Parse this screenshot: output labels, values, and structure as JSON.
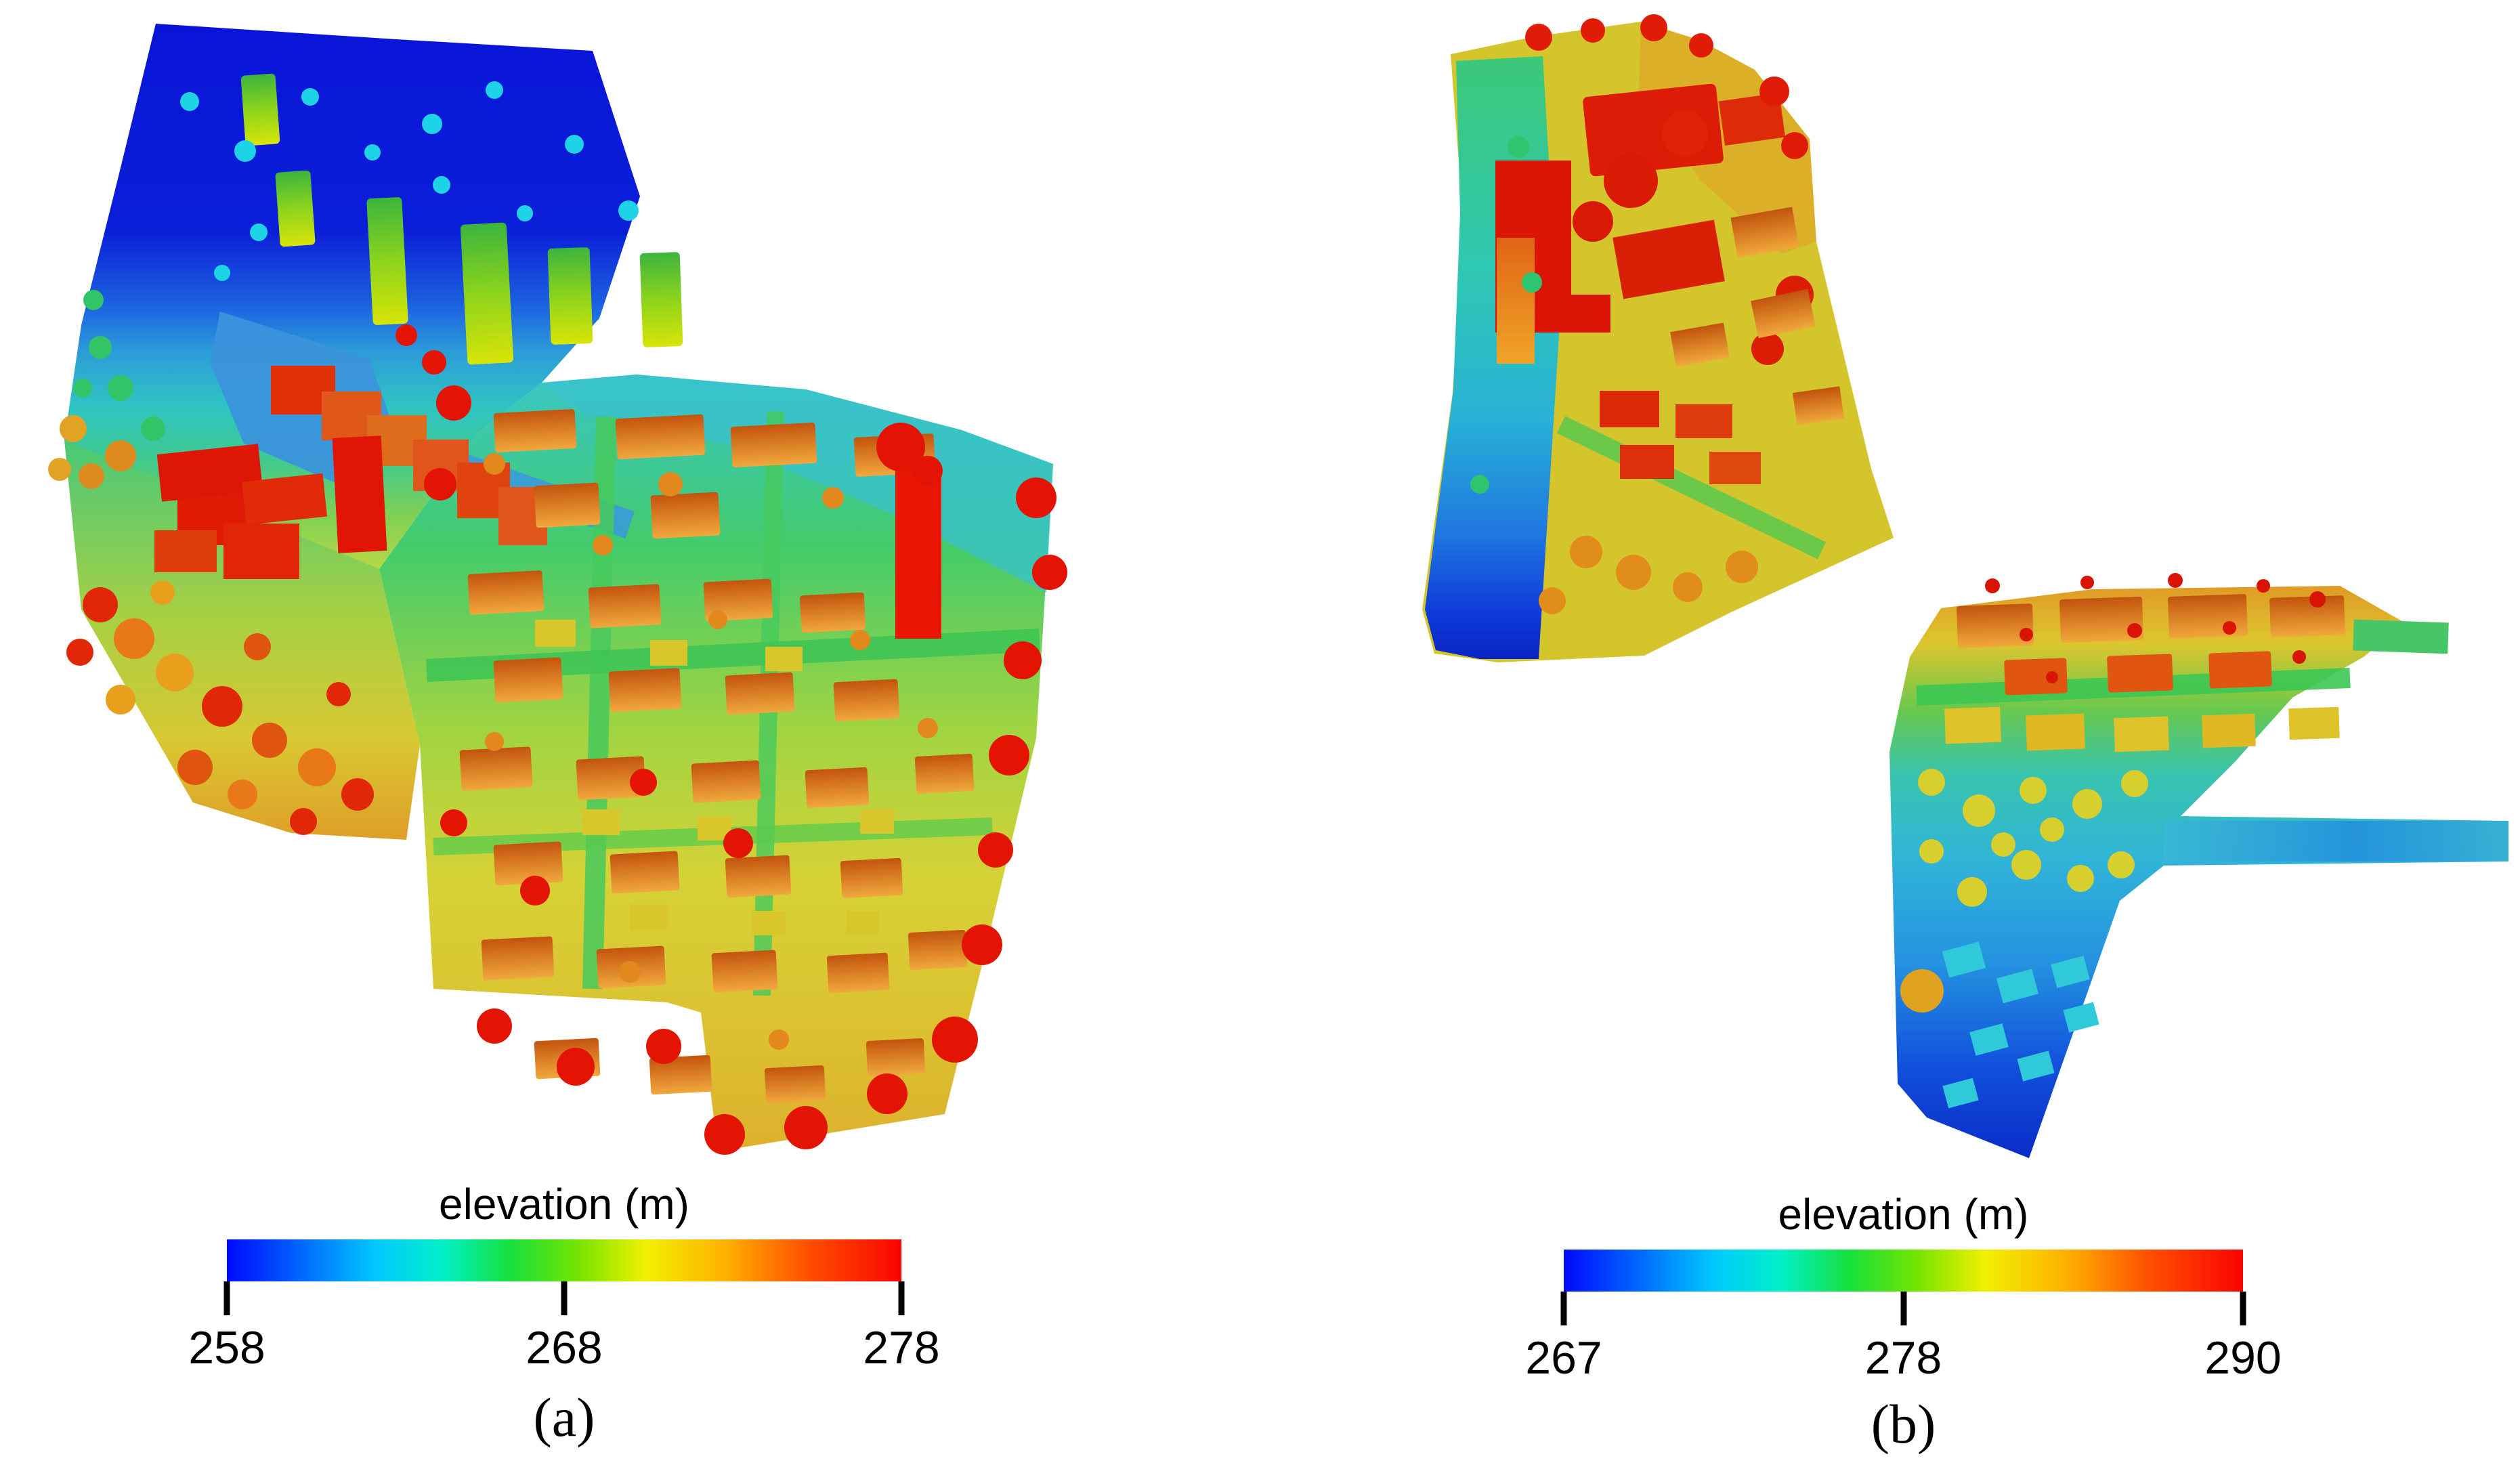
{
  "figure": {
    "background": "#ffffff",
    "text_color": "#000000",
    "panels": [
      {
        "id": "a",
        "caption": "(a)",
        "map_alt": "LiDAR elevation raster of urban area (a): low blue terrain (~258 m) in the north-west block with tall green-roofed buildings, rising through cyan and green streets to yellow-orange terrain (~270-278 m) in the south-east covered with red-roofed building rows and red tree crowns",
        "colorbar": {
          "title": "elevation (m)",
          "unit": "m",
          "min": 258,
          "max": 278,
          "ticks": [
            258,
            268,
            278
          ],
          "tick_positions": [
            0,
            0.5,
            1
          ],
          "gradient": [
            {
              "pos": 0,
              "color": "#0009ff"
            },
            {
              "pos": 0.12,
              "color": "#0070ff"
            },
            {
              "pos": 0.22,
              "color": "#00c8ff"
            },
            {
              "pos": 0.32,
              "color": "#00f0c8"
            },
            {
              "pos": 0.42,
              "color": "#16e03c"
            },
            {
              "pos": 0.52,
              "color": "#74e400"
            },
            {
              "pos": 0.62,
              "color": "#f0f000"
            },
            {
              "pos": 0.74,
              "color": "#ffb000"
            },
            {
              "pos": 0.86,
              "color": "#ff5000"
            },
            {
              "pos": 1,
              "color": "#fa0400"
            }
          ]
        }
      },
      {
        "id": "b",
        "caption": "(b)",
        "map_alt": "LiDAR elevation raster (b) in two disjoint patches: upper patch with a cyan-to-blue valley strip on its west edge and high red rooftops (~290 m) on yellow terrain to the east; lower patch sloping from orange-red building rows in the north through green and cyan to blue terrain (~267 m) at the south tip, with a thin cyan corridor extending east",
        "colorbar": {
          "title": "elevation (m)",
          "unit": "m",
          "min": 267,
          "max": 290,
          "ticks": [
            267,
            278,
            290
          ],
          "tick_positions": [
            0,
            0.5,
            1
          ],
          "gradient": [
            {
              "pos": 0,
              "color": "#0009ff"
            },
            {
              "pos": 0.12,
              "color": "#0070ff"
            },
            {
              "pos": 0.22,
              "color": "#00c8ff"
            },
            {
              "pos": 0.32,
              "color": "#00f0c8"
            },
            {
              "pos": 0.42,
              "color": "#16e03c"
            },
            {
              "pos": 0.52,
              "color": "#74e400"
            },
            {
              "pos": 0.62,
              "color": "#f0f000"
            },
            {
              "pos": 0.74,
              "color": "#ffb000"
            },
            {
              "pos": 0.86,
              "color": "#ff5000"
            },
            {
              "pos": 1,
              "color": "#fa0400"
            }
          ]
        }
      }
    ]
  },
  "chart_data": [
    {
      "type": "heatmap",
      "title": "elevation (m)",
      "caption": "(a)",
      "colorbar": {
        "orientation": "horizontal",
        "min": 258,
        "mid": 268,
        "max": 278,
        "ticks": [
          258,
          268,
          278
        ],
        "unit": "m",
        "colormap": "jet (blue-cyan-green-yellow-orange-red)"
      },
      "legend_position": "bottom",
      "description": "Digital surface model of an urban residential district; elevations span 258 m (blue, north-west block) to 278 m (red rooftops and tree crowns, south-east blocks)."
    },
    {
      "type": "heatmap",
      "title": "elevation (m)",
      "caption": "(b)",
      "colorbar": {
        "orientation": "horizontal",
        "min": 267,
        "mid": 278,
        "max": 290,
        "ticks": [
          267,
          278,
          290
        ],
        "unit": "m",
        "colormap": "jet (blue-cyan-green-yellow-orange-red)"
      },
      "legend_position": "bottom",
      "description": "Digital surface model in two disjoint patches; elevations span 267 m (blue valley floor and southern tip) to 290 m (red rooftops in the north-east of the upper patch)."
    }
  ]
}
